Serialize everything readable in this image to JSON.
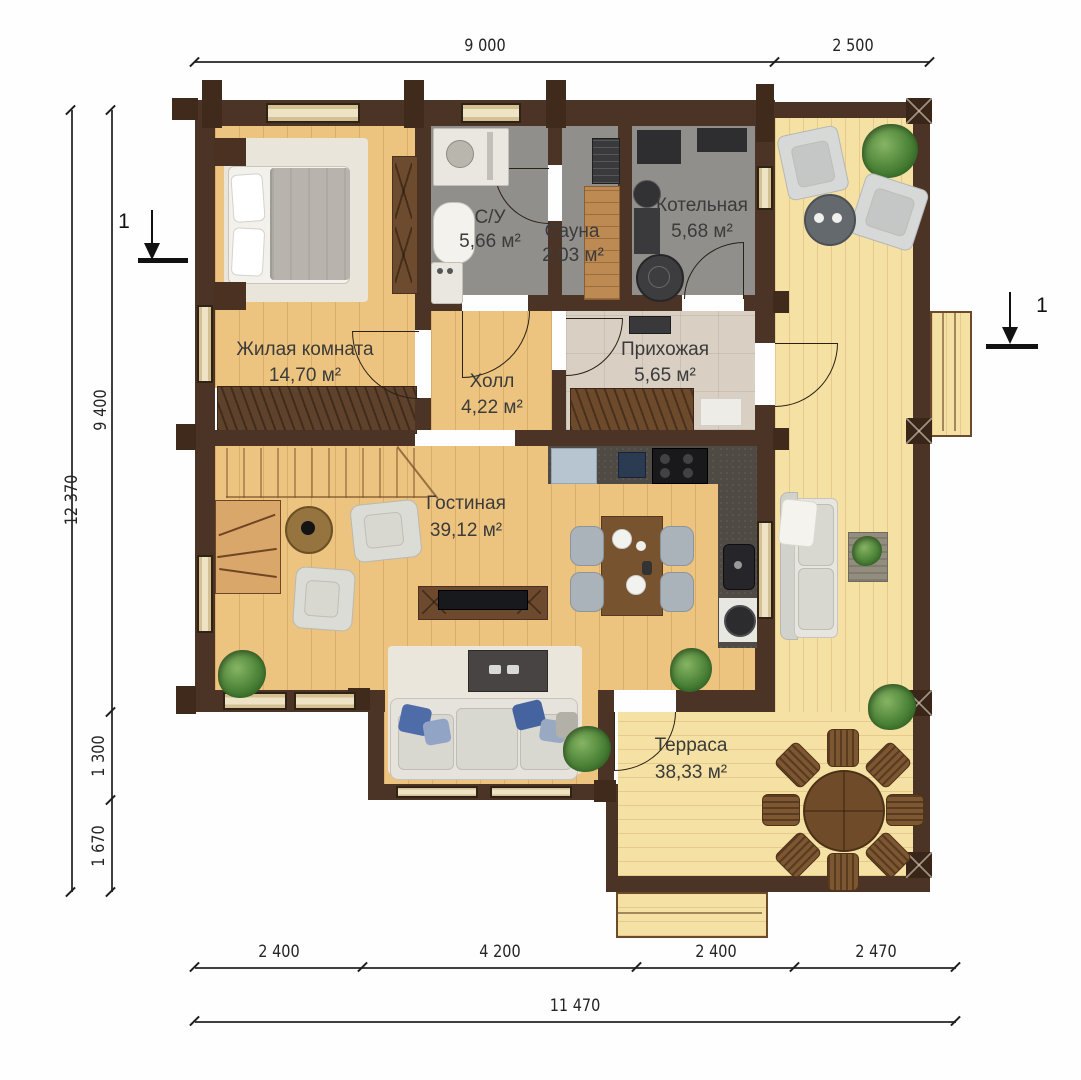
{
  "plan": {
    "section_marker": "1",
    "rooms": [
      {
        "name": "Жилая комната",
        "area": "14,70 м²"
      },
      {
        "name": "С/У",
        "area": "5,66 м²"
      },
      {
        "name": "Сауна",
        "area": "2,03 м²"
      },
      {
        "name": "Котельная",
        "area": "5,68 м²"
      },
      {
        "name": "Прихожая",
        "area": "5,65 м²"
      },
      {
        "name": "Холл",
        "area": "4,22 м²"
      },
      {
        "name": "Гостиная",
        "area": "39,12 м²"
      },
      {
        "name": "Терраса",
        "area": "38,33 м²"
      }
    ],
    "dimensions": {
      "top": [
        "9 000",
        "2 500"
      ],
      "left_total": "12 370",
      "left_segments": [
        "9 400",
        "1 300",
        "1 670"
      ],
      "bottom_segments": [
        "2 400",
        "4 200",
        "2 400",
        "2 470"
      ],
      "bottom_total": "11 470"
    },
    "colors": {
      "wall": "#4b3425",
      "interior_floor": "#ecc47f",
      "terrace_floor": "#f4e1a3",
      "wet_room_floor": "#908f8b",
      "hallway_floor": "#d9d0c3",
      "plant_green": "#4a8136"
    }
  }
}
